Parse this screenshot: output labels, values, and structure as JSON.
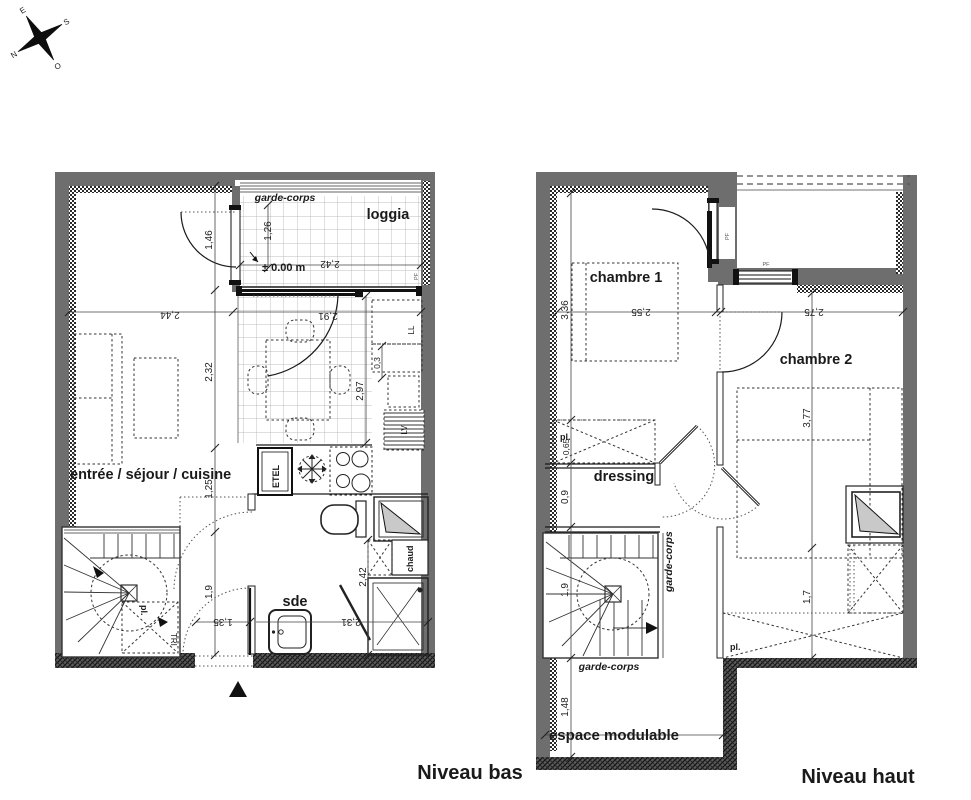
{
  "compass": {
    "north": "N",
    "south": "S",
    "east": "E",
    "west": "O"
  },
  "niveau_bas": {
    "title": "Niveau bas",
    "rooms": {
      "loggia": "loggia",
      "sejour": "entrée / séjour / cuisine",
      "sde": "sde"
    },
    "labels": {
      "garde_corps": "garde-corps",
      "level_mark": "± 0.00 m",
      "chaud": "chaud",
      "etel": "ETEL",
      "washer": "LL",
      "dishwasher": "LV",
      "closet": "pl.",
      "tri": "TRI",
      "window_tag": "PF"
    },
    "dims": {
      "w_sejour": "2,44",
      "w_kitchen": "2,91",
      "w_loggia": "2,42",
      "h_loggia": "1,26",
      "h_entry": "1,46",
      "h_sejour": "2,32",
      "h_kitchen": "2,97",
      "d_appliance": "0,3",
      "h_mid": "1,25",
      "h_hall": "1,9",
      "w_hall": "1,35",
      "w_sde": "2,31",
      "h_sde": "2,42"
    }
  },
  "niveau_haut": {
    "title": "Niveau haut",
    "rooms": {
      "chambre1": "chambre 1",
      "chambre2": "chambre 2",
      "dressing": "dressing",
      "espace": "espace modulable"
    },
    "labels": {
      "closet_dressing": "pl.",
      "closet_bottom": "pl.",
      "garde_corps_side": "garde-corps",
      "garde_corps_bottom": "garde-corps",
      "window_tag": "PF"
    },
    "dims": {
      "h_ch1": "3,36",
      "w_ch1": "2,55",
      "w_ch2": "2,75",
      "h_pl": "0,65",
      "h_dressing": "0,9",
      "h_stair": "1,9",
      "h_espace": "1,48",
      "h_ch2": "3,77",
      "h_pl2": "1,7"
    }
  }
}
